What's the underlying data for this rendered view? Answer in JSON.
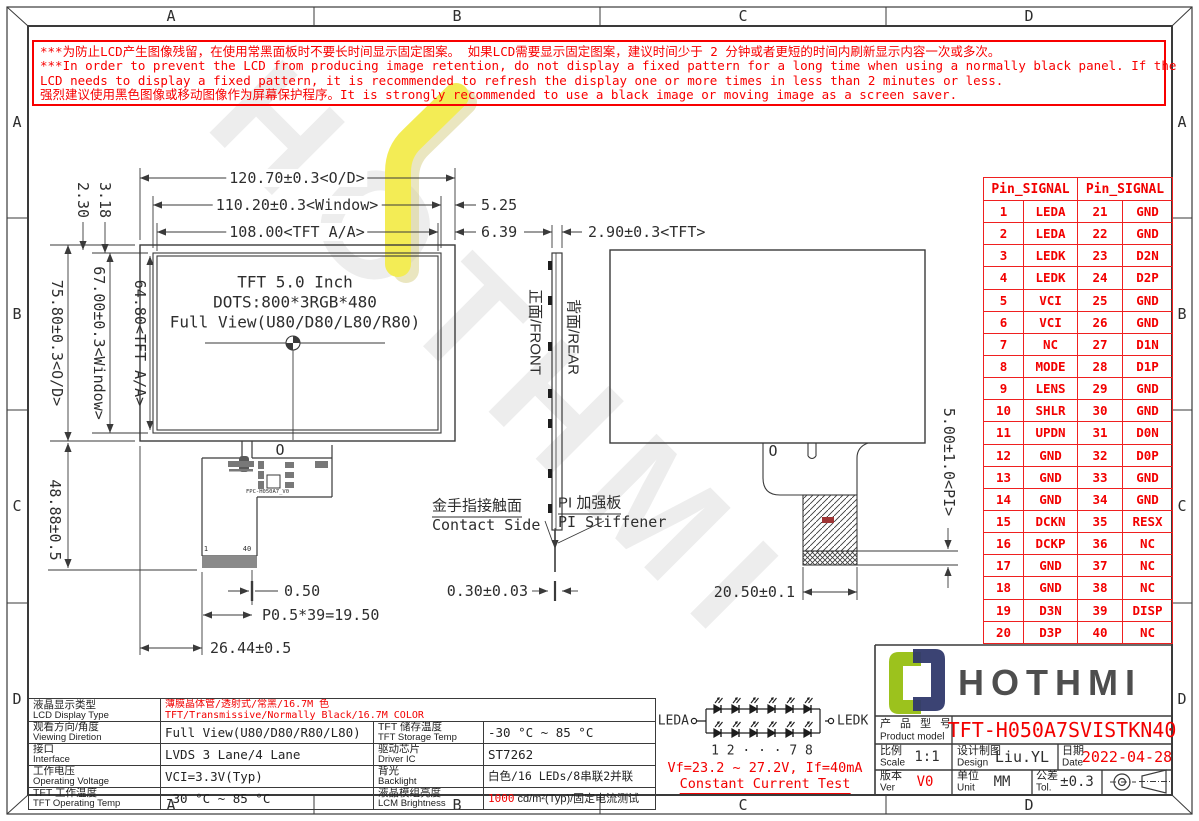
{
  "frame": {
    "cols": [
      "A",
      "B",
      "C",
      "D"
    ],
    "rows": [
      "A",
      "B",
      "C",
      "D"
    ]
  },
  "warning": {
    "line1": "***为防止LCD产生图像残留，在使用常黑面板时不要长时间显示固定图案。 如果LCD需要显示固定图案，建议时间少于 2 分钟或者更短的时间内刷新显示内容一次或多次。",
    "line2": "***In order to prevent the LCD from producing image retention, do not display a fixed pattern for a long time when using a normally black panel. If the",
    "line3": " LCD needs to display a fixed pattern, it is recommended to refresh the display one or more times in less than 2 minutes or less.",
    "line4": "强烈建议使用黑色图像或移动图像作为屏幕保护程序。It is strongly recommended to use a black image or moving image as a screen saver."
  },
  "front_view": {
    "line1": "TFT 5.0 Inch",
    "line2": "DOTS:800*3RGB*480",
    "line3": "Full View(U80/D80/L80/R80)",
    "zero": "O",
    "pin_first": "1",
    "pin_last": "40",
    "fpc_label": "FPC-H050A7_V0"
  },
  "dims": {
    "od_width": "120.70±0.3<O/D>",
    "window_width": "110.20±0.3<Window>",
    "aa_width": "108.00<TFT A/A>",
    "window_right_offset": "5.25",
    "aa_right_offset": "6.39",
    "tft_thickness": "2.90±0.3<TFT>",
    "od_height": "75.80±0.3<O/D>",
    "window_height": "67.00±0.3<Window>",
    "aa_height": "64.80<TFT A/A>",
    "top_offset_a": "2.30",
    "top_offset_b": "3.18",
    "fpc_length": "48.88±0.5",
    "pin_width": "0.50",
    "pin_pitch": "P0.5*39=19.50",
    "fpc_offset": "26.44±0.5",
    "contact_thickness": "0.30±0.03",
    "stiffener_width": "20.50±0.1",
    "pi_height": "5.00±1.0<PI>"
  },
  "side_view": {
    "front": "正面/FRONT",
    "rear": "背面/REAR",
    "contact_zh": "金手指接触面",
    "contact_en": "Contact Side",
    "stiffener_zh": "PI 加强板",
    "stiffener_en": "PI Stiffener"
  },
  "rear_view": {
    "zero": "O"
  },
  "pin_table": {
    "header_left": "Pin_SIGNAL",
    "header_right": "Pin_SIGNAL",
    "rows": [
      [
        "1",
        "LEDA",
        "21",
        "GND"
      ],
      [
        "2",
        "LEDA",
        "22",
        "GND"
      ],
      [
        "3",
        "LEDK",
        "23",
        "D2N"
      ],
      [
        "4",
        "LEDK",
        "24",
        "D2P"
      ],
      [
        "5",
        "VCI",
        "25",
        "GND"
      ],
      [
        "6",
        "VCI",
        "26",
        "GND"
      ],
      [
        "7",
        "NC",
        "27",
        "D1N"
      ],
      [
        "8",
        "MODE",
        "28",
        "D1P"
      ],
      [
        "9",
        "LENS",
        "29",
        "GND"
      ],
      [
        "10",
        "SHLR",
        "30",
        "GND"
      ],
      [
        "11",
        "UPDN",
        "31",
        "D0N"
      ],
      [
        "12",
        "GND",
        "32",
        "D0P"
      ],
      [
        "13",
        "GND",
        "33",
        "GND"
      ],
      [
        "14",
        "GND",
        "34",
        "GND"
      ],
      [
        "15",
        "DCKN",
        "35",
        "RESX"
      ],
      [
        "16",
        "DCKP",
        "36",
        "NC"
      ],
      [
        "17",
        "GND",
        "37",
        "NC"
      ],
      [
        "18",
        "GND",
        "38",
        "NC"
      ],
      [
        "19",
        "D3N",
        "39",
        "DISP"
      ],
      [
        "20",
        "D3P",
        "40",
        "NC"
      ]
    ]
  },
  "spec": {
    "rows_left": [
      {
        "label_zh": "液晶显示类型",
        "label_en": "LCD Display Type",
        "value_zh": "薄膜晶体管/透射式/常黑/16.7M 色",
        "value_en": "TFT/Transmissive/Normally Black/16.7M COLOR"
      },
      {
        "label_zh": "观看方向/角度",
        "label_en": "Viewing Diretion",
        "value": "Full View(U80/D80/R80/L80)"
      },
      {
        "label_zh": "接口",
        "label_en": "Interface",
        "value": "LVDS 3 Lane/4 Lane"
      },
      {
        "label_zh": "工作电压",
        "label_en": "Operating Voltage",
        "value": "VCI=3.3V(Typ)"
      },
      {
        "label_zh": "TFT 工作温度",
        "label_en": "TFT Operating Temp",
        "value": "-30 °C ~ 85 °C"
      }
    ],
    "rows_right": [
      {
        "label_zh": "TFT 储存温度",
        "label_en": "TFT Storage Temp",
        "value": "-30 °C ~ 85 °C"
      },
      {
        "label_zh": "驱动芯片",
        "label_en": "Driver IC",
        "value": "ST7262"
      },
      {
        "label_zh": "背光",
        "label_en": "Backlight",
        "value": "白色/16 LEDs/8串联2并联"
      },
      {
        "label_zh": "液晶模组亮度",
        "label_en": "LCM Brightness",
        "value_red": "1000",
        "value_rest": " cd/m²(Typ)/固定电流测试"
      }
    ]
  },
  "led_circuit": {
    "anode": "LEDA",
    "cathode": "LEDK",
    "numbers": "1  2  · · ·  7  8",
    "vf": "Vf=23.2 ~ 27.2V, If=40mA",
    "note": "Constant Current Test"
  },
  "title_block": {
    "brand": "HOTHMI",
    "product_label_zh": "产 品 型 号",
    "product_label_en": "Product model",
    "model": "TFT-H050A7SVISTKN40",
    "scale_zh": "比例",
    "scale_en": "Scale",
    "scale": "1:1",
    "design_zh": "设计制图",
    "design_en": "Design",
    "designer": "Liu.YL",
    "date_zh": "日期",
    "date_en": "Date",
    "date": "2022-04-28",
    "ver_zh": "版本",
    "ver_en": "Ver",
    "ver": "V0",
    "unit_zh": "单位",
    "unit_en": "Unit",
    "unit": "MM",
    "tol_zh": "公差",
    "tol_en": "Tol.",
    "tol": "±0.3"
  }
}
